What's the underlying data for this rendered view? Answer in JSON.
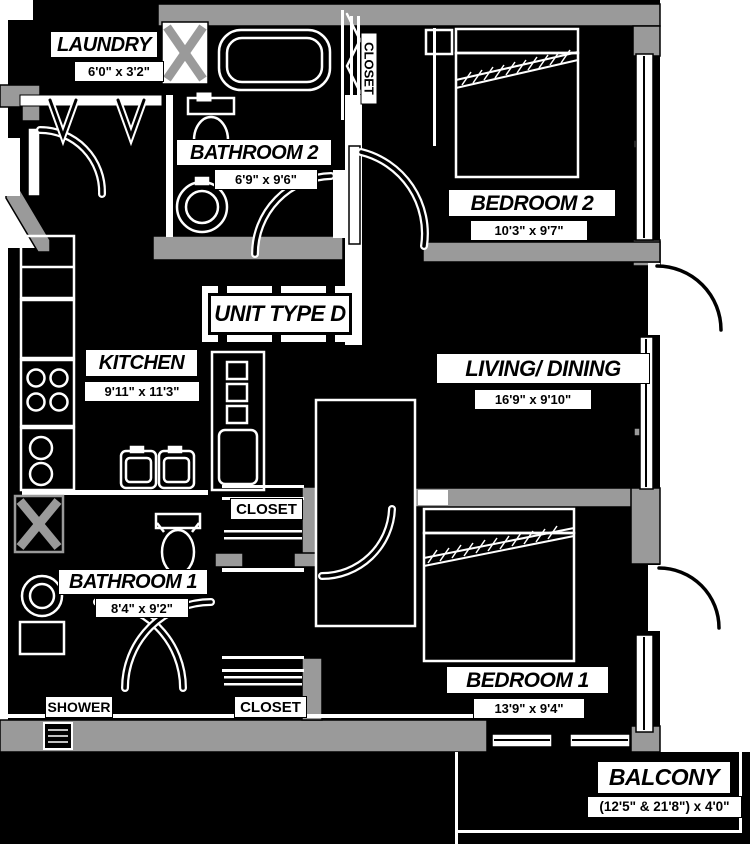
{
  "floorplan": {
    "title": "UNIT TYPE D",
    "rooms": [
      {
        "name": "LAUNDRY",
        "dims": "6'0\" x 3'2\""
      },
      {
        "name": "BATHROOM 2",
        "dims": "6'9\" x 9'6\""
      },
      {
        "name": "BEDROOM 2",
        "dims": "10'3\" x 9'7\""
      },
      {
        "name": "KITCHEN",
        "dims": "9'11\" x 11'3\""
      },
      {
        "name": "LIVING/ DINING",
        "dims": "16'9\" x 9'10\""
      },
      {
        "name": "BATHROOM 1",
        "dims": "8'4\" x 9'2\""
      },
      {
        "name": "BEDROOM 1",
        "dims": "13'9\" x 9'4\""
      },
      {
        "name": "BALCONY",
        "dims": "(12'5\" & 21'8\") x 4'0\""
      }
    ],
    "closet_label": "CLOSET",
    "shower_label": "SHOWER",
    "colors": {
      "wall_gray": "#9a9a9a",
      "floor_black": "#000000",
      "paper_white": "#ffffff",
      "line_black": "#111111"
    }
  }
}
